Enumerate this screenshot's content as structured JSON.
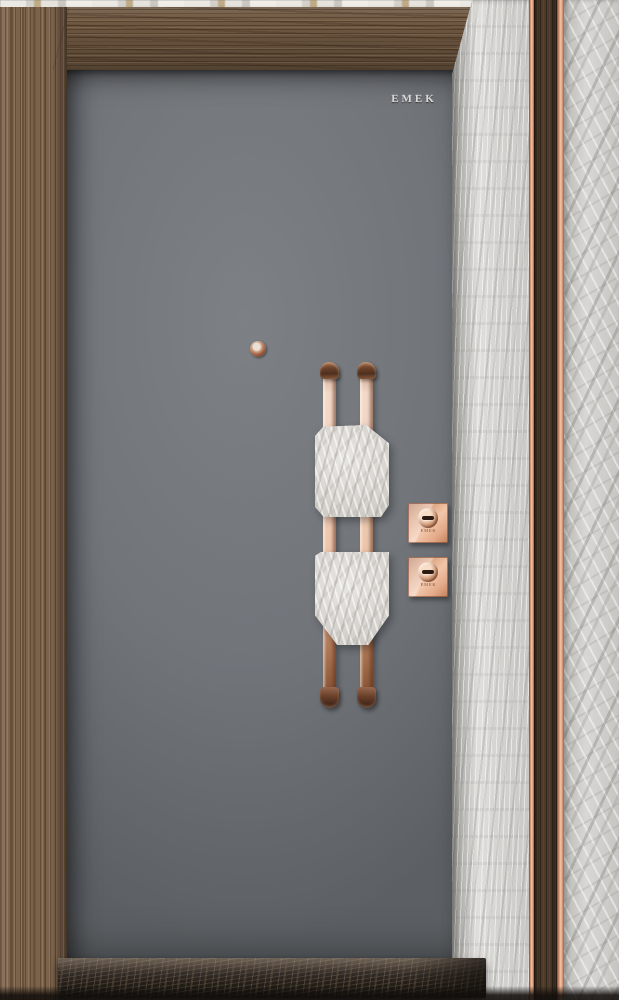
{
  "scene": {
    "type": "product-photo",
    "subject": "Modern steel security door with walnut frame, grey slab, marble pilasters and rose-gold hardware"
  },
  "door": {
    "brand_logo": "EMEK",
    "panel_color": "#71757a"
  },
  "hardware": {
    "handle": {
      "style": "twin vertical rose-gold hook bars with chamfered marble grip plates",
      "bar_color": "#ecc3a8",
      "plate_color": "#dad8d4"
    },
    "locks": [
      {
        "label": "EMEK"
      },
      {
        "label": "EMEK"
      }
    ],
    "peephole_color": "#b06a4e"
  },
  "materials": {
    "frame_wood": "#7b624a",
    "marble_light": "#d3d2cf",
    "dark_wood_reveal": "#4c3a2b",
    "copper_accent": "#e0a584",
    "threshold_marble": "#2f2823"
  }
}
